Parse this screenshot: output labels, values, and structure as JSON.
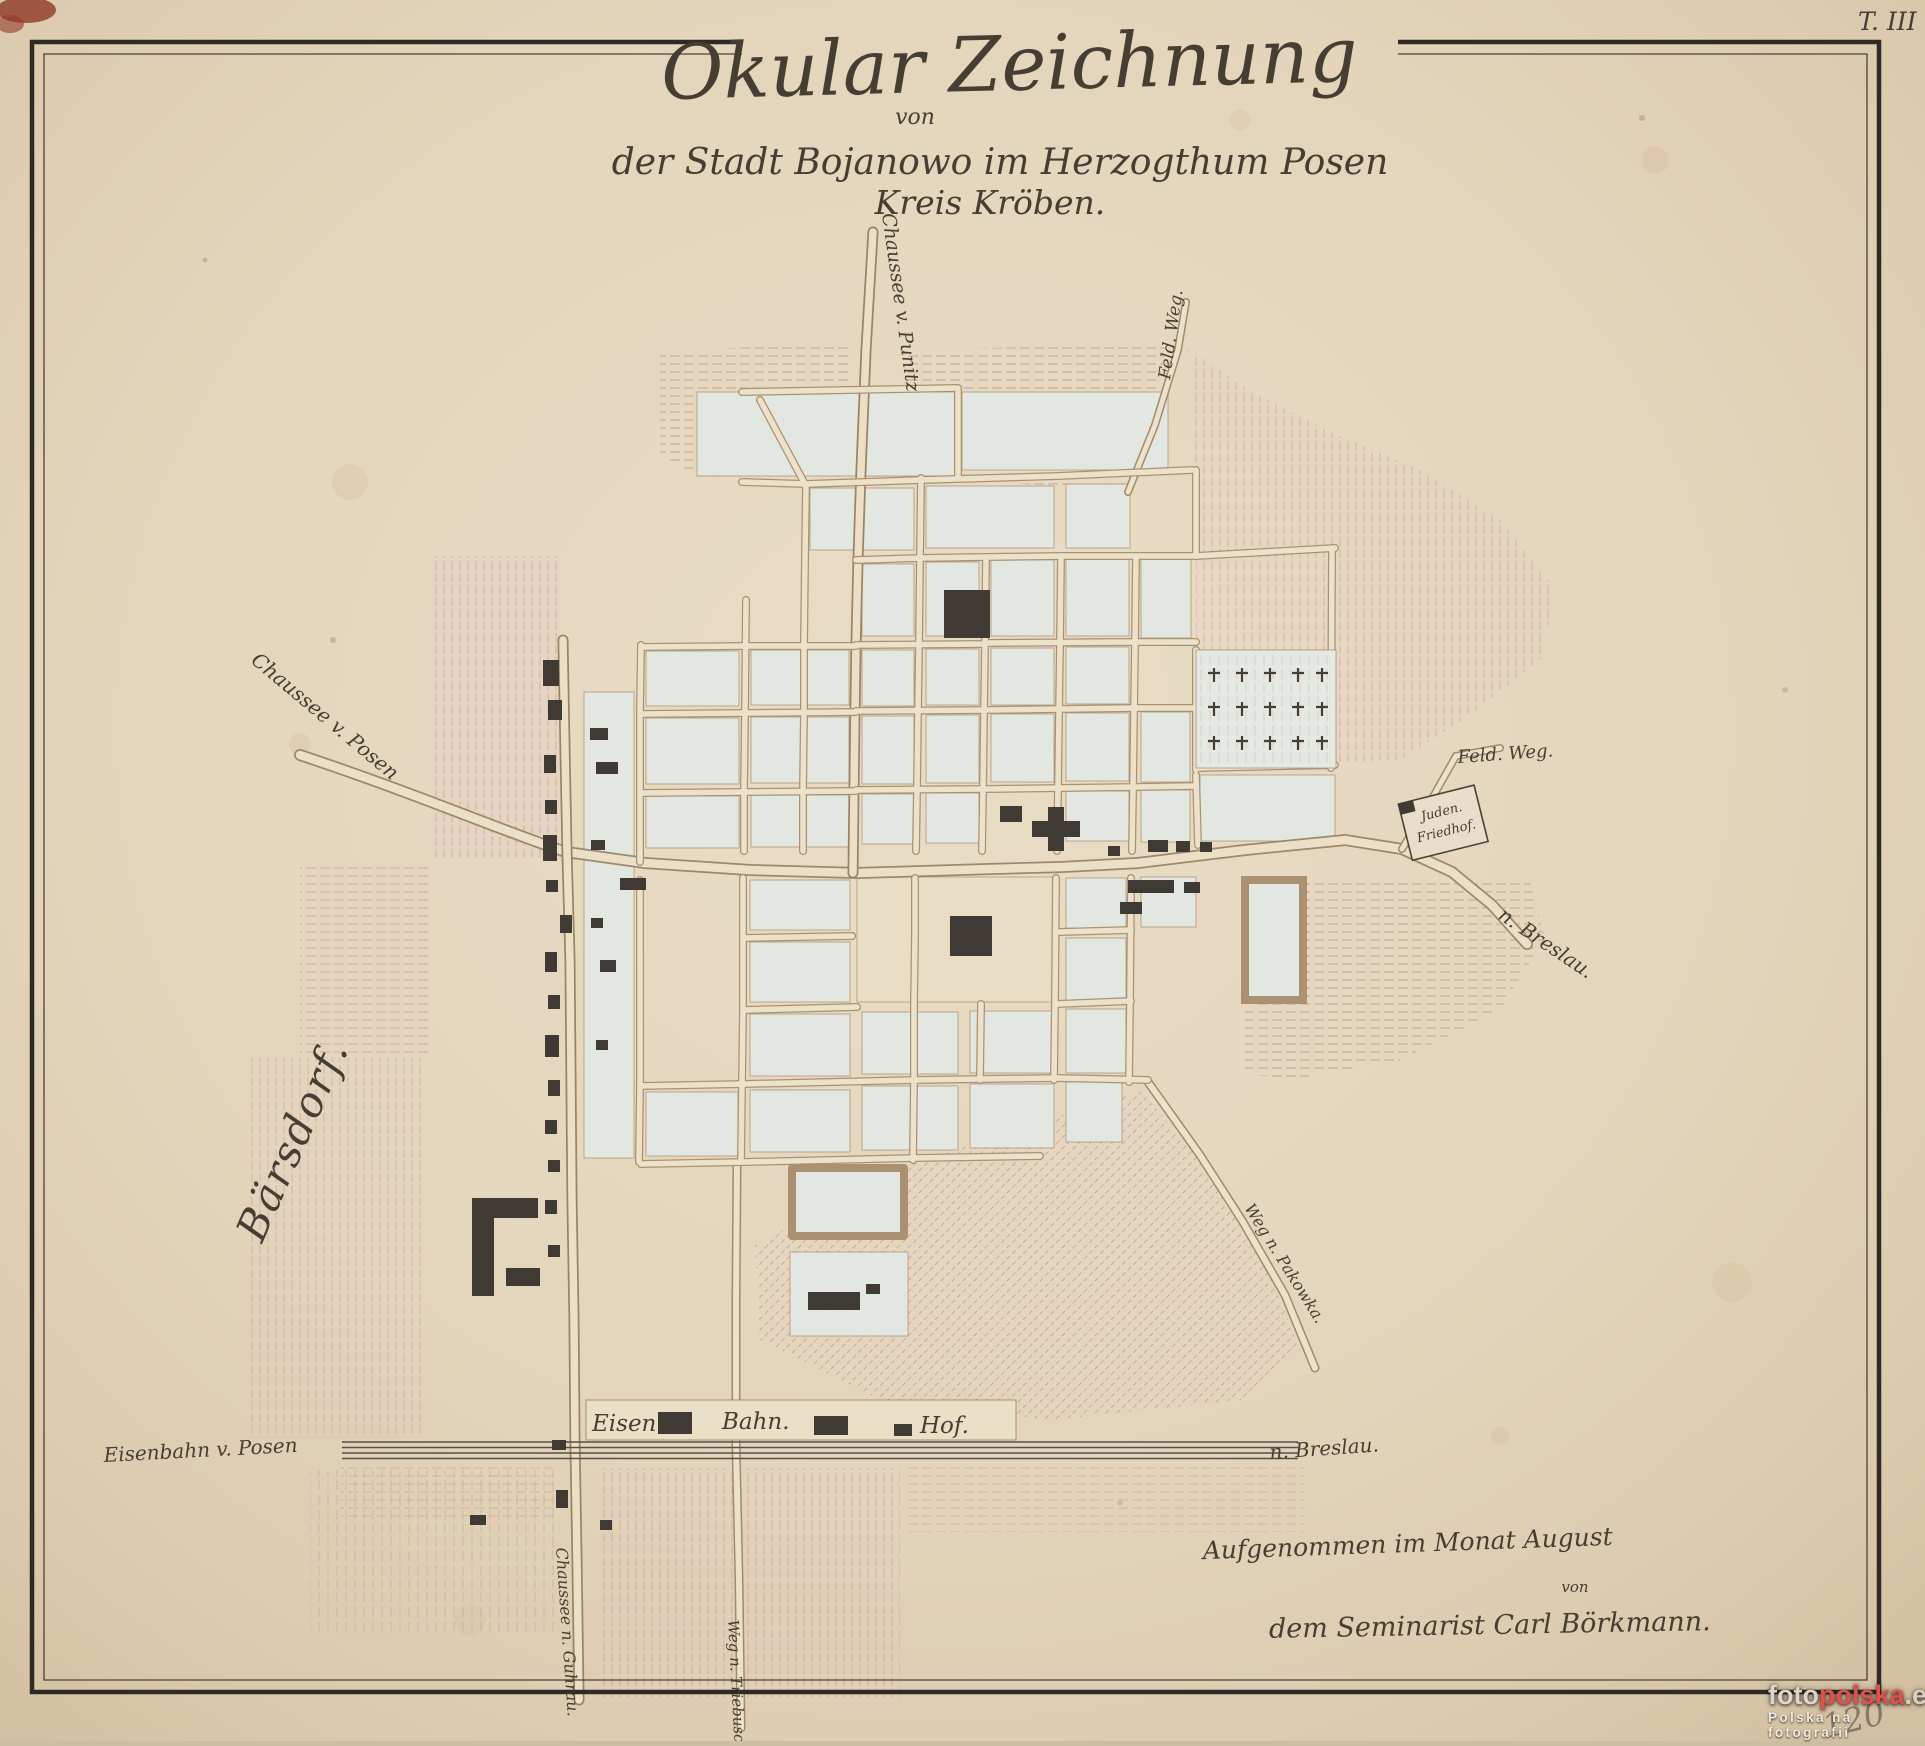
{
  "document": {
    "sheet_mark": "T. III",
    "archive_number": "120"
  },
  "title": {
    "line1": "Okular Zeichnung",
    "line2": "von",
    "line3": "der Stadt Bojanowo im Herzogthum Posen",
    "line4": "Kreis Kröben."
  },
  "map_labels": {
    "chaussee_punitz": "Chaussee v. Punitz",
    "feld_weg_north": "Feld. Weg.",
    "feld_weg_east": "Feld. Weg.",
    "chaussee_posen": "Chaussee v. Posen",
    "nach_breslau_chaussee": "n. Breslau.",
    "juden_friedhof_line1": "Juden.",
    "juden_friedhof_line2": "Friedhof.",
    "barsdorf": "Bärsdorf.",
    "weg_pakowka": "Weg n. Pakowka.",
    "eisenbahn_posen": "Eisenbahn v. Posen",
    "station_eisen": "Eisen.",
    "station_bahn": "Bahn.",
    "station_hof": "Hof.",
    "nach_breslau_eisenbahn": "n. Breslau.",
    "chaussee_guhrau": "Chaussee n. Guhrau.",
    "weg_triebusch": "Weg n. Triebusch."
  },
  "attribution": {
    "line1": "Aufgenommen im Monat August",
    "line2": "von",
    "line3": "dem Seminarist Carl Börkmann."
  },
  "watermark": {
    "brand_foto": "foto",
    "brand_polska": "polska",
    "brand_eu": ".eu",
    "tagline": "Polska na fotografii",
    "brand_color": "#e2504c"
  },
  "palette": {
    "paper": "#e5d7c0",
    "ink": "#463e33",
    "building": "#3f3a33",
    "field_hatch": "#c98f85",
    "town_block": "#e3e9e5",
    "road_fill": "#ece2cb"
  }
}
